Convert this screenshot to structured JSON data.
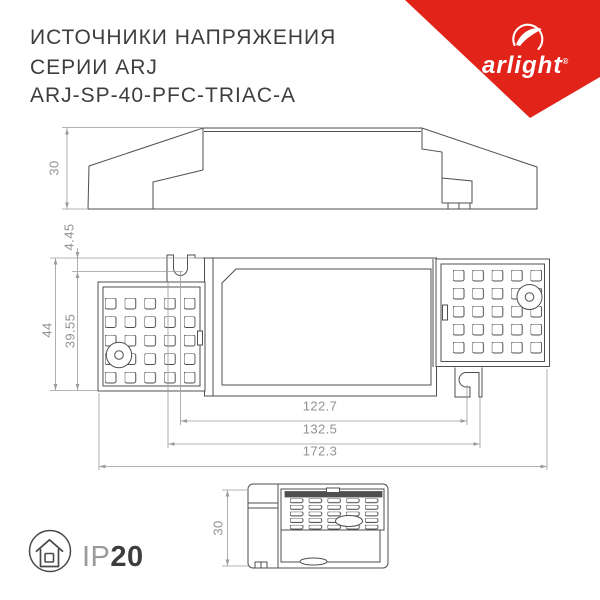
{
  "title": {
    "line1": "ИСТОЧНИКИ НАПРЯЖЕНИЯ",
    "line2": "СЕРИИ ARJ",
    "line3": "ARJ-SP-40-PFC-TRIAC-A"
  },
  "logo": {
    "brand": "arlight",
    "registered": "®"
  },
  "dimensions": {
    "side_height": "30",
    "top_offset": "4.45",
    "top_height": "44",
    "top_inner_height": "39.55",
    "width_inner": "122.7",
    "width_mid": "132.5",
    "width_total": "172.3",
    "end_height": "30"
  },
  "footer": {
    "ip_prefix": "IP",
    "ip_value": "20"
  },
  "colors": {
    "brand_red": "#e2231a",
    "drawing_line": "#4f4f4f",
    "dimension_gray": "#9b9b9b",
    "title_text": "#3e3e3e"
  }
}
